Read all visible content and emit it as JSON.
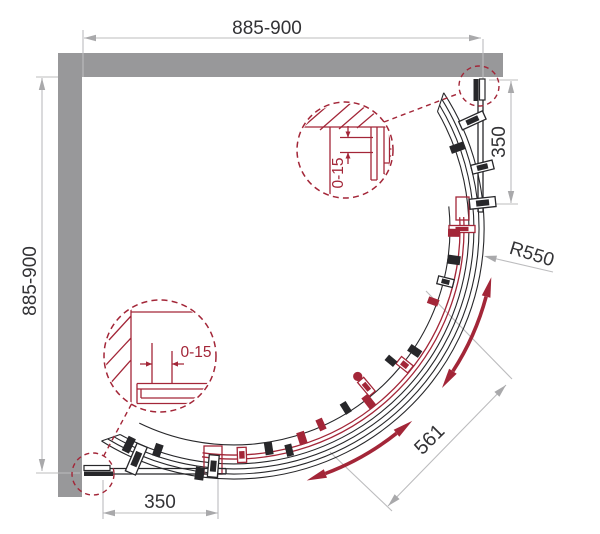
{
  "drawing": {
    "dimensions": {
      "width": "885-900",
      "height": "885-900",
      "fixed_segment_right": "350",
      "fixed_segment_bottom": "350",
      "radius": "R550",
      "door_opening": "561",
      "wall_adjustment_top": "0-15",
      "wall_adjustment_bottom": "0-15"
    },
    "colors": {
      "wall": "#98989a",
      "line": "#27272a",
      "accent": "#a32638",
      "dim_line": "#bcbcbe",
      "dim_arrow": "#a9a9ab",
      "text": "#333336",
      "background": "#ffffff"
    },
    "center": {
      "x": 234,
      "y": 229
    },
    "hardware": [
      {
        "a": -24.5,
        "r": 262,
        "l": 26,
        "w": 9,
        "c": "line",
        "s": "clamp"
      },
      {
        "a": -20,
        "r": 238,
        "l": 15,
        "w": 8,
        "c": "line",
        "s": "solid"
      },
      {
        "a": -14,
        "r": 256,
        "l": 22,
        "w": 9,
        "c": "line",
        "s": "clamp"
      },
      {
        "a": -6,
        "r": 250,
        "l": 26,
        "w": 10,
        "c": "line",
        "s": "clamp"
      },
      {
        "a": 0,
        "r": 228,
        "l": 26,
        "w": 7,
        "c": "accent",
        "s": "clamp"
      },
      {
        "a": 1,
        "r": 220,
        "l": 12,
        "w": 8,
        "c": "accent",
        "s": "solid"
      },
      {
        "a": 8,
        "r": 222,
        "l": 13,
        "w": 9,
        "c": "line",
        "s": "solid"
      },
      {
        "a": 14,
        "r": 218,
        "l": 16,
        "w": 8,
        "c": "line",
        "s": "clamp"
      },
      {
        "a": 20,
        "r": 212,
        "l": 11,
        "w": 7,
        "c": "accent",
        "s": "solid"
      },
      {
        "a": 34,
        "r": 218,
        "l": 13,
        "w": 8,
        "c": "line",
        "s": "solid"
      },
      {
        "a": 38.5,
        "r": 218,
        "l": 15,
        "w": 9,
        "c": "accent",
        "s": "clamp"
      },
      {
        "a": 40,
        "r": 205,
        "l": 11,
        "w": 7,
        "c": "line",
        "s": "solid"
      },
      {
        "a": 50,
        "r": 206,
        "l": 18,
        "w": 8,
        "c": "accent",
        "s": "clamp",
        "knob": true
      },
      {
        "a": 52,
        "r": 219,
        "l": 14,
        "w": 8,
        "c": "accent",
        "s": "solid"
      },
      {
        "a": 58,
        "r": 211,
        "l": 12,
        "w": 7,
        "c": "line",
        "s": "solid"
      },
      {
        "a": 66,
        "r": 214,
        "l": 12,
        "w": 7,
        "c": "accent",
        "s": "solid"
      },
      {
        "a": 72,
        "r": 220,
        "l": 13,
        "w": 8,
        "c": "accent",
        "s": "solid"
      },
      {
        "a": 76,
        "r": 228,
        "l": 12,
        "w": 7,
        "c": "line",
        "s": "solid"
      },
      {
        "a": 81,
        "r": 222,
        "l": 13,
        "w": 8,
        "c": "line",
        "s": "solid"
      },
      {
        "a": 88,
        "r": 226,
        "l": 15,
        "w": 9,
        "c": "accent",
        "s": "clamp"
      },
      {
        "a": 95,
        "r": 238,
        "l": 22,
        "w": 10,
        "c": "line",
        "s": "clamp"
      },
      {
        "a": 98,
        "r": 247,
        "l": 13,
        "w": 9,
        "c": "line",
        "s": "solid"
      },
      {
        "a": 109,
        "r": 234,
        "l": 13,
        "w": 8,
        "c": "line",
        "s": "solid"
      },
      {
        "a": 113,
        "r": 250,
        "l": 30,
        "w": 11,
        "c": "line",
        "s": "clamp"
      },
      {
        "a": 116,
        "r": 240,
        "l": 16,
        "w": 8,
        "c": "line",
        "s": "solid"
      }
    ]
  }
}
